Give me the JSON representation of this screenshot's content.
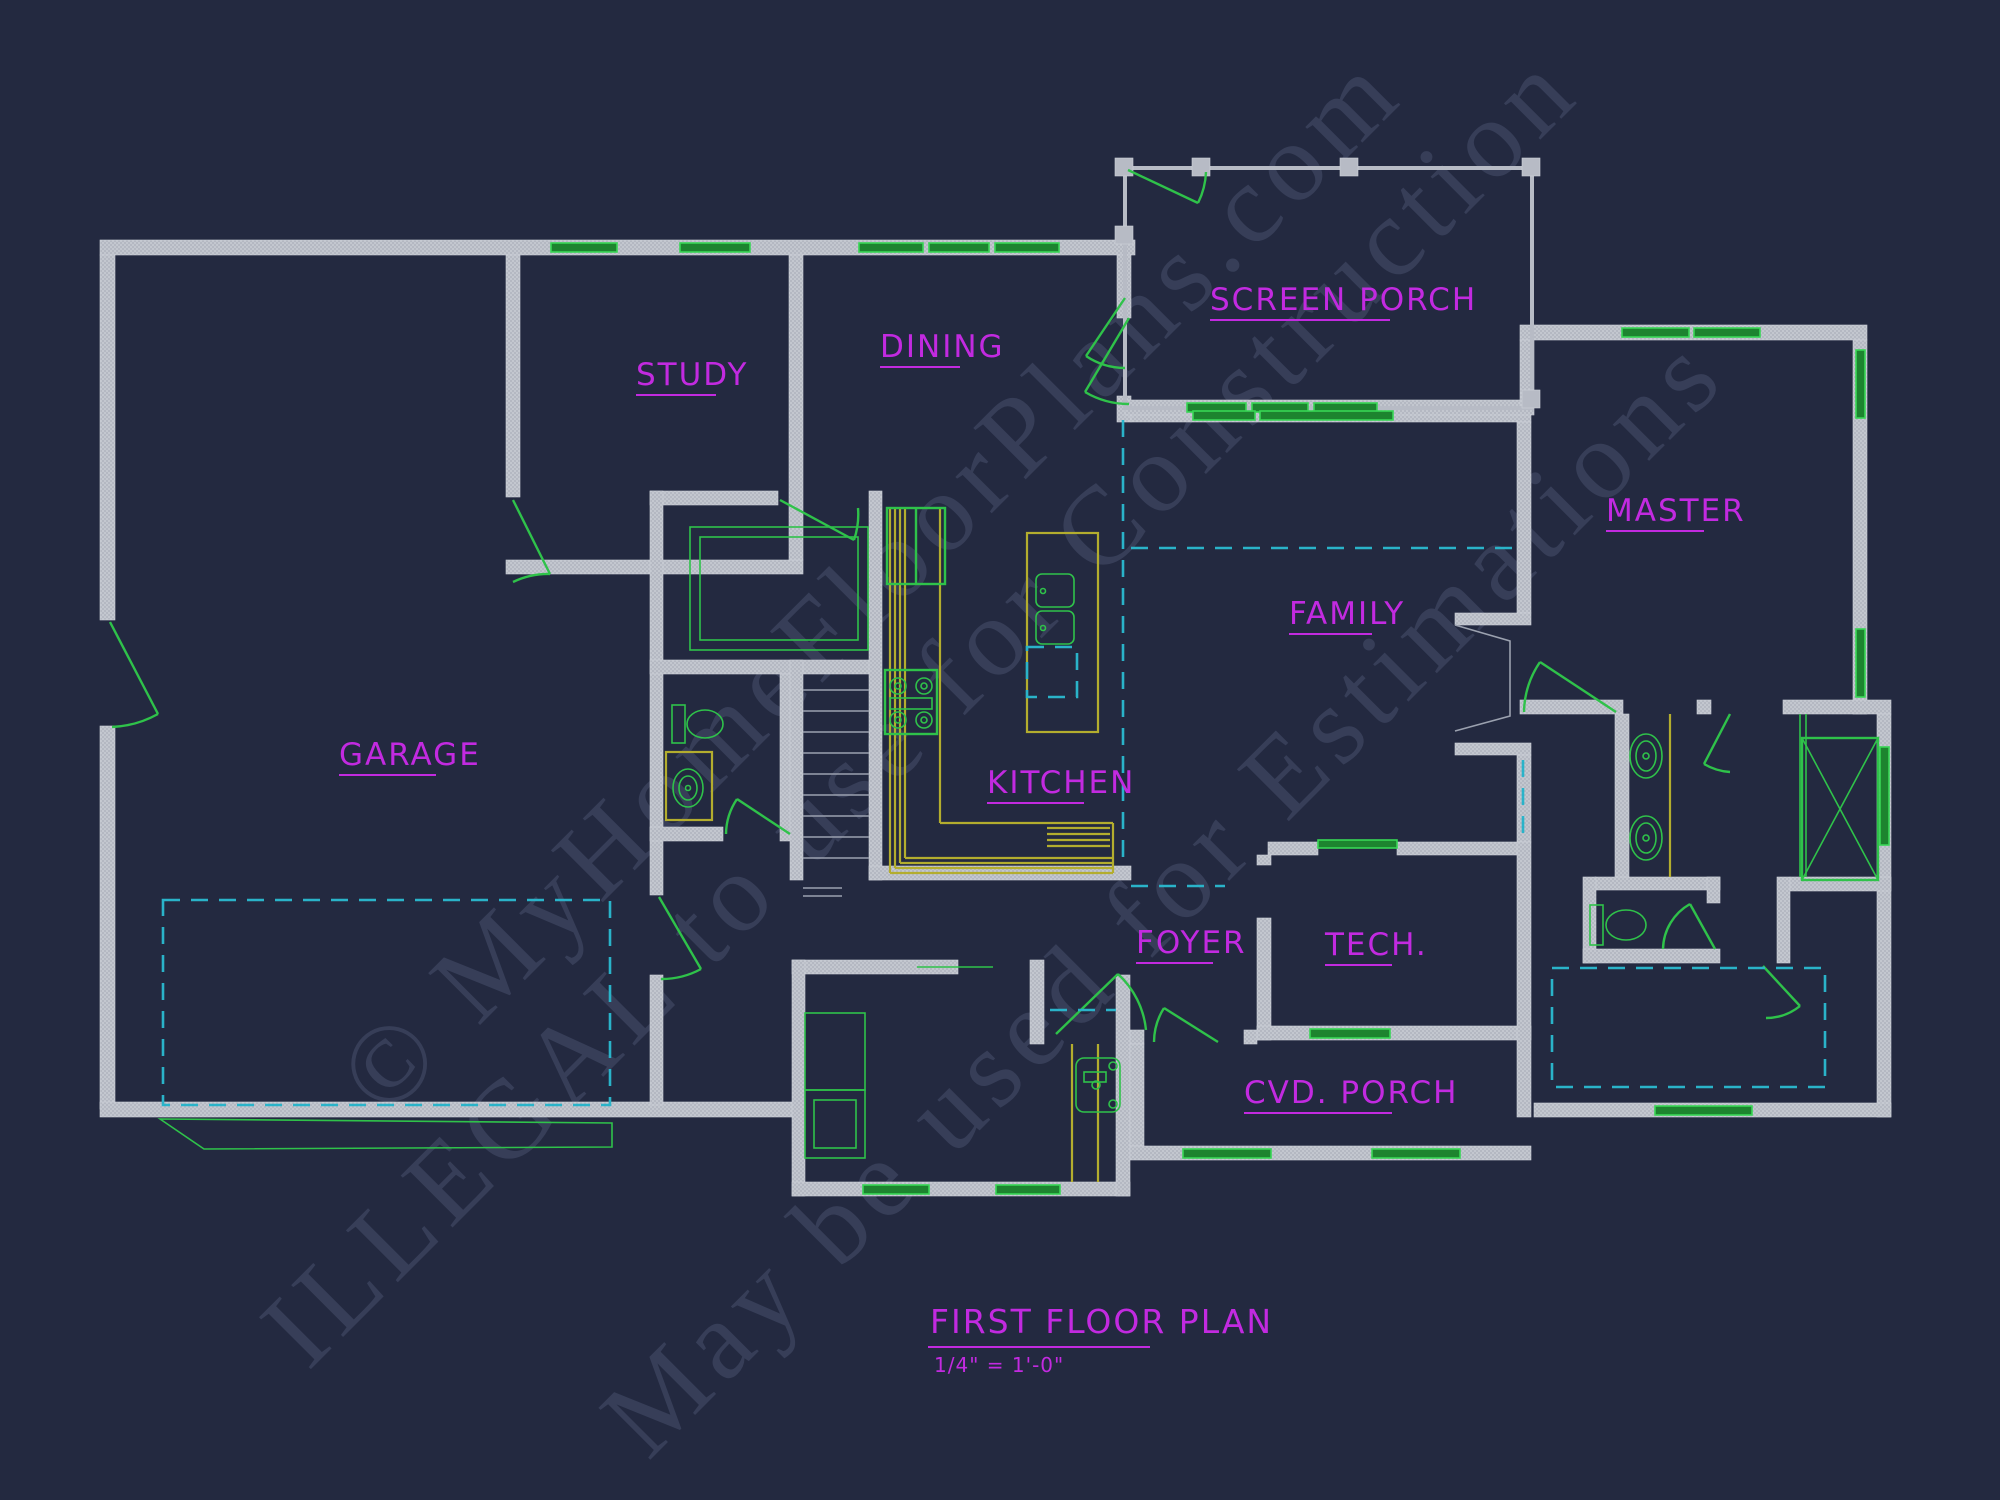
{
  "drawing": {
    "title": "FIRST FLOOR PLAN",
    "scale": "1/4\" = 1'-0\"",
    "rooms": [
      {
        "id": "garage",
        "label": "GARAGE"
      },
      {
        "id": "study",
        "label": "STUDY"
      },
      {
        "id": "dining",
        "label": "DINING"
      },
      {
        "id": "screen_porch",
        "label": "SCREEN PORCH"
      },
      {
        "id": "master",
        "label": "MASTER"
      },
      {
        "id": "family",
        "label": "FAMILY"
      },
      {
        "id": "kitchen",
        "label": "KITCHEN"
      },
      {
        "id": "foyer",
        "label": "FOYER"
      },
      {
        "id": "tech",
        "label": "TECH."
      },
      {
        "id": "cvd_porch",
        "label": "CVD. PORCH"
      }
    ],
    "watermark": {
      "line1": "© MyHomeFloorPlans.com",
      "line2": "ILLEGAL to use for Construction",
      "line3": "May be used for Estimations"
    },
    "symbols": [
      "wall",
      "window",
      "door-swing",
      "stairs",
      "toilet",
      "sink",
      "shower",
      "range",
      "refrigerator",
      "kitchen-island",
      "fireplace",
      "garage-door-dashed",
      "lockers"
    ],
    "colors": {
      "background": "#232940",
      "wall_gray": "#b7bbc5",
      "line_green": "#2fc24a",
      "label_magenta": "#c22ae0",
      "counter_yellow": "#b3ad2e",
      "dashed_cyan": "#2ab3c9",
      "watermark": "#3c445f"
    }
  }
}
